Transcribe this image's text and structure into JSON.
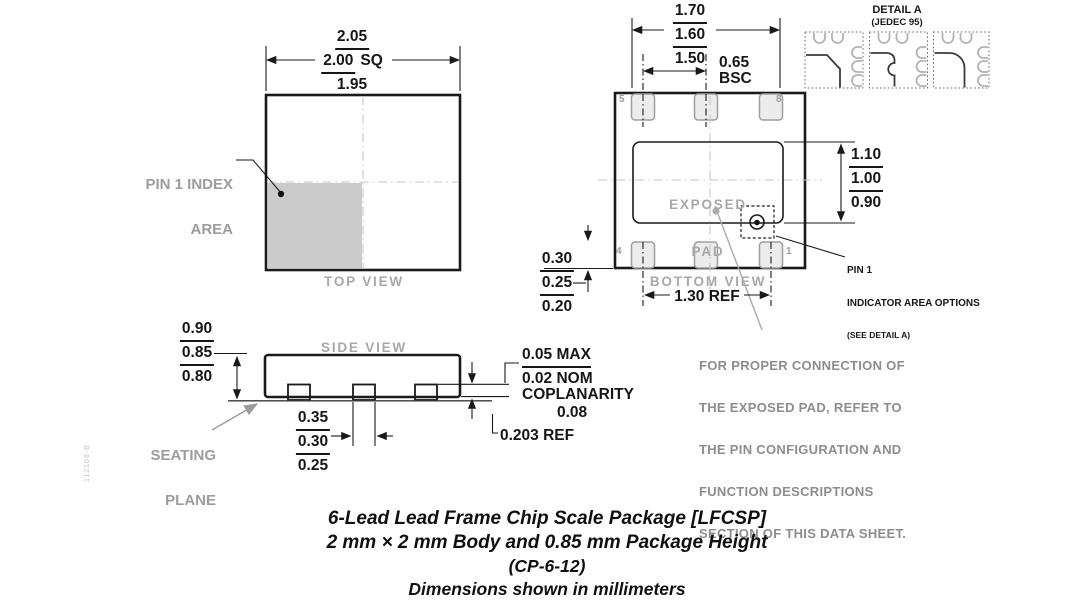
{
  "top_view": {
    "label": "TOP VIEW",
    "size_dims": [
      "2.05",
      "2.00",
      "1.95"
    ],
    "size_suffix": "SQ",
    "pin1_label_line1": "PIN 1 INDEX",
    "pin1_label_line2": "AREA"
  },
  "bottom_view": {
    "label": "BOTTOM VIEW",
    "width_dims": [
      "1.70",
      "1.60",
      "1.50"
    ],
    "pitch_value": "0.65",
    "pitch_unit": "BSC",
    "pad_width_dims": [
      "0.30",
      "0.25",
      "0.20"
    ],
    "pad_span_ref": "1.30 REF",
    "exposed_pad_label_line1": "EXPOSED",
    "exposed_pad_label_line2": "PAD",
    "exposed_pad_dims": [
      "1.10",
      "1.00",
      "0.90"
    ],
    "pin_numbers": {
      "top_left": "5",
      "top_right": "8",
      "bottom_left": "4",
      "bottom_right": "1"
    },
    "pin1_note_line1": "PIN 1",
    "pin1_note_line2": "INDICATOR AREA OPTIONS",
    "pin1_note_line3": "(SEE DETAIL A)"
  },
  "detail_a": {
    "title": "DETAIL A",
    "subtitle": "(JEDEC 95)"
  },
  "side_view": {
    "label": "SIDE VIEW",
    "height_dims": [
      "0.90",
      "0.85",
      "0.80"
    ],
    "seating_label_line1": "SEATING",
    "seating_label_line2": "PLANE",
    "lead_width_dims": [
      "0.35",
      "0.30",
      "0.25"
    ],
    "standoff_dims": [
      "0.05 MAX",
      "0.02 NOM"
    ],
    "coplanarity_label": "COPLANARITY",
    "coplanarity_value": "0.08",
    "lead_thickness_ref": "0.203 REF"
  },
  "connection_note": {
    "lines": [
      "FOR PROPER CONNECTION OF",
      "THE EXPOSED PAD, REFER TO",
      "THE PIN CONFIGURATION AND",
      "FUNCTION DESCRIPTIONS",
      "SECTION OF THIS DATA SHEET."
    ]
  },
  "title_block": {
    "line1": "6-Lead Lead Frame Chip Scale Package [LFCSP]",
    "line2": "2 mm × 2 mm Body and 0.85 mm Package Height",
    "line3": "(CP-6-12)",
    "line4": "Dimensions shown in millimeters"
  },
  "revision_code": "112108-B",
  "colors": {
    "line": "#1a1a1a",
    "gray_label": "#a8a8a8",
    "note_gray": "#8d8d8d",
    "pad_fill": "#ececec",
    "pin1_area_fill": "#cbcbcb"
  }
}
